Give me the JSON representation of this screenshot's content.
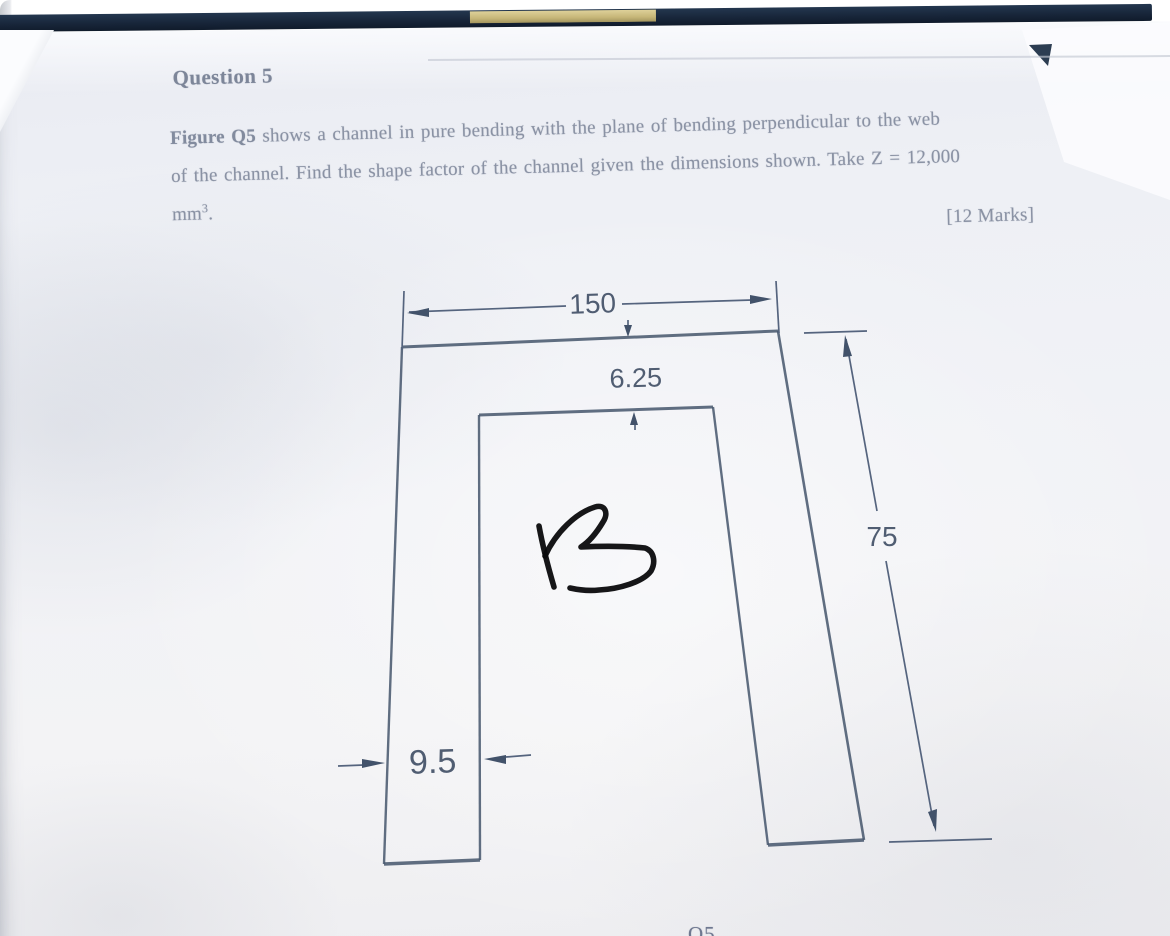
{
  "document": {
    "title": "Question 5",
    "body": {
      "line1_bold": "Figure Q5",
      "line1_rest": " shows a channel in pure bending with the plane of bending perpendicular to the web",
      "line2": "of the channel. Find the shape factor of the channel given the dimensions shown. Take Z = 12,000",
      "line3_unit": "mm",
      "line3_sup": "3",
      "line3_punct": ".",
      "marks": "[12 Marks]"
    },
    "figure": {
      "dim_width": "150",
      "dim_flange_thickness": "6.25",
      "dim_height": "75",
      "dim_web_thickness": "9.5",
      "handwritten_mark": "B",
      "caption_partial": "Q5"
    },
    "colors": {
      "binder_band": "#1f3049",
      "binder_accent": "#cdbf87",
      "print_ink": "#8a92a4",
      "diagram_ink": "#4a5a70",
      "handwriting_ink": "#0a0a0c"
    }
  }
}
